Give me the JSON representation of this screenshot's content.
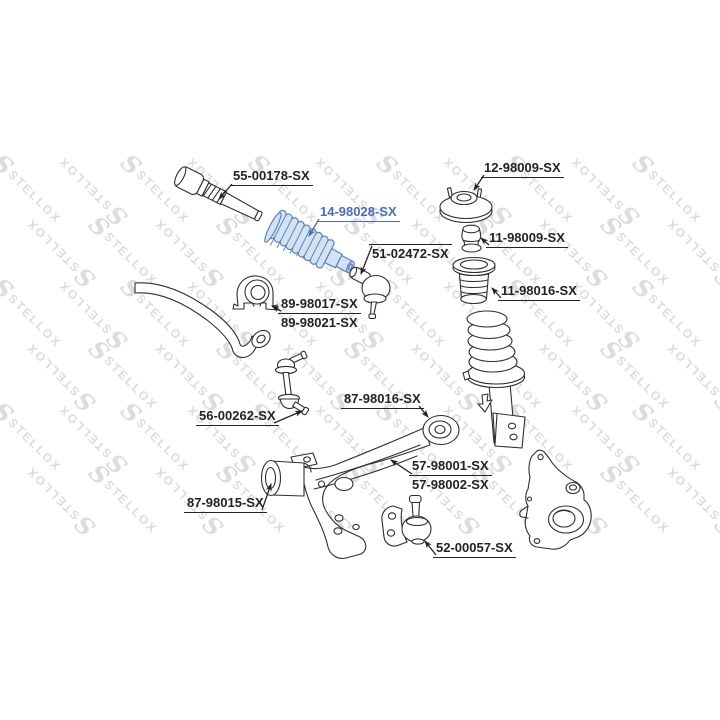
{
  "watermark": {
    "text": "STELLOX",
    "color": "#dcdcdc"
  },
  "colors": {
    "line": "#2f2f2f",
    "label_text": "#232323",
    "highlight_text": "#4a6cb3",
    "highlight_stroke": "#5d82bb",
    "highlight_fill": "#d3e3f3"
  },
  "labels": [
    {
      "id": "tie-rod",
      "text": "55-00178-SX"
    },
    {
      "id": "steering-rack-boot",
      "text": "14-98028-SX",
      "highlighted": true
    },
    {
      "id": "tie-rod-end",
      "text": "51-02472-SX"
    },
    {
      "id": "strut-mount",
      "text": "12-98009-SX"
    },
    {
      "id": "bump-stop",
      "text": "11-98009-SX"
    },
    {
      "id": "strut-dust-boot",
      "text": "11-98016-SX"
    },
    {
      "id": "stabilizer-bushing-a",
      "text": "89-98017-SX"
    },
    {
      "id": "stabilizer-bushing-b",
      "text": "89-98021-SX"
    },
    {
      "id": "stabilizer-link",
      "text": "56-00262-SX"
    },
    {
      "id": "arm-rear-bushing",
      "text": "87-98016-SX"
    },
    {
      "id": "control-arm-a",
      "text": "57-98001-SX"
    },
    {
      "id": "control-arm-b",
      "text": "57-98002-SX"
    },
    {
      "id": "arm-front-bushing",
      "text": "87-98015-SX"
    },
    {
      "id": "lower-ball-joint",
      "text": "52-00057-SX"
    }
  ]
}
